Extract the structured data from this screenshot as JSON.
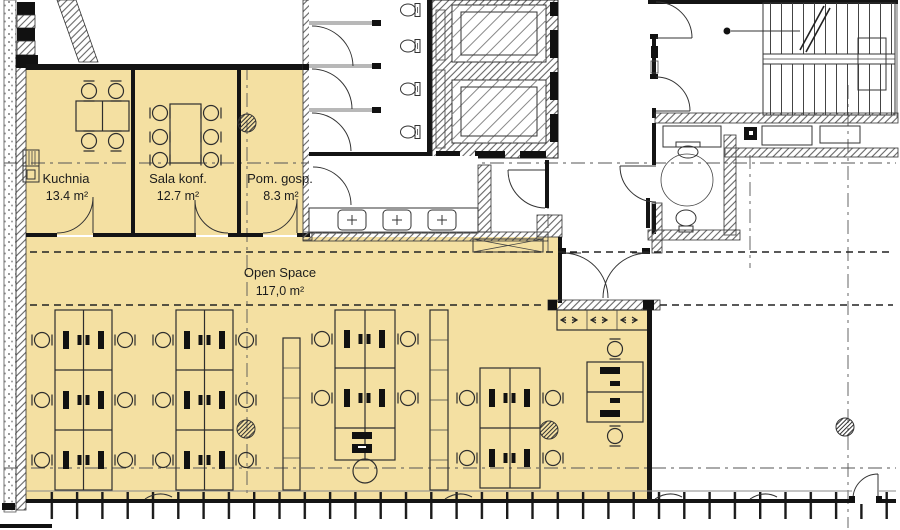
{
  "plan": {
    "rooms": [
      {
        "id": "kuchnia",
        "name": "Kuchnia",
        "area": "13.4 m²"
      },
      {
        "id": "sala-konf",
        "name": "Sala konf.",
        "area": "12.7 m²"
      },
      {
        "id": "pom-gosp",
        "name": "Pom. gosp.",
        "area": "8.3 m²"
      },
      {
        "id": "open-space",
        "name": "Open Space",
        "area": "117,0 m²"
      }
    ],
    "colors": {
      "highlight": "#F4E0A2",
      "wall": "#141414",
      "line": "#333333"
    }
  }
}
